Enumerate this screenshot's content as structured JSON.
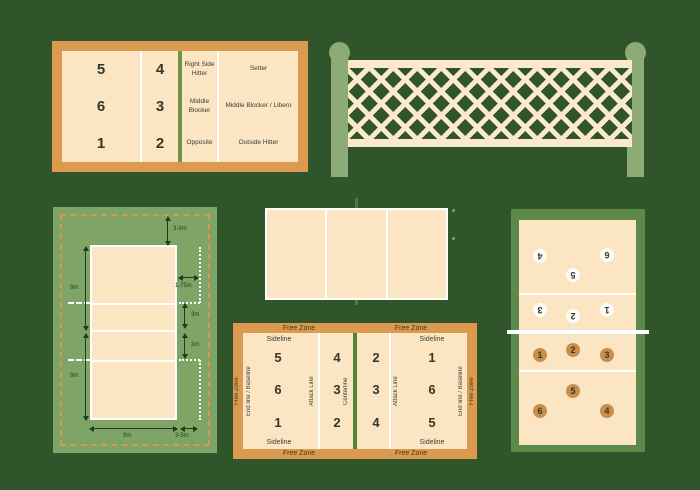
{
  "palette": {
    "background": "#31552a",
    "free_zone_orange": "#dc9a51",
    "court_cream": "#fbe5c3",
    "net_cream": "#fbe9cc",
    "sage_panel": "#7ea567",
    "dark_panel_green": "#5d8a4b",
    "net_post_green": "#8cab77",
    "line_white": "#ffffff",
    "center_line_green": "#6f9445",
    "arrow_dark_green": "#1e3d1c",
    "player_circle_orange": "#c98e4a",
    "player_circle_white": "#fdfdf6"
  },
  "positions_court": {
    "numbers_back": [
      "5",
      "6",
      "1"
    ],
    "numbers_front": [
      "4",
      "3",
      "2"
    ],
    "roles_front": [
      "Right Side Hitter",
      "Middle Blocker",
      "Opposite"
    ],
    "roles_back": [
      "Setter",
      "Middle Blocker / Libero",
      "Outside Hitter"
    ]
  },
  "dimensions_court": {
    "end_free_zone": "3-8m",
    "half_length_top": "9m",
    "half_length_bottom": "9m",
    "attack_line_extension": "1.75m",
    "attack_to_center_top": "3m",
    "attack_to_center_bottom": "3m",
    "court_width": "9m",
    "side_free_zone": "3-5m"
  },
  "zones_court": {
    "free_zone": "Free Zone",
    "sideline": "Sideline",
    "end_line": "End line / Baseline",
    "attack_line": "Attack Line",
    "center_line": "Centerline",
    "left_back_numbers": [
      "5",
      "6",
      "1"
    ],
    "left_front_numbers": [
      "4",
      "3",
      "2"
    ],
    "right_front_numbers": [
      "2",
      "3",
      "4"
    ],
    "right_back_numbers": [
      "1",
      "6",
      "5"
    ]
  },
  "lineup_court": {
    "top_team": [
      "4",
      "6",
      "5",
      "3",
      "2",
      "1"
    ],
    "bottom_team": [
      "2",
      "1",
      "3",
      "5",
      "6",
      "4"
    ]
  }
}
